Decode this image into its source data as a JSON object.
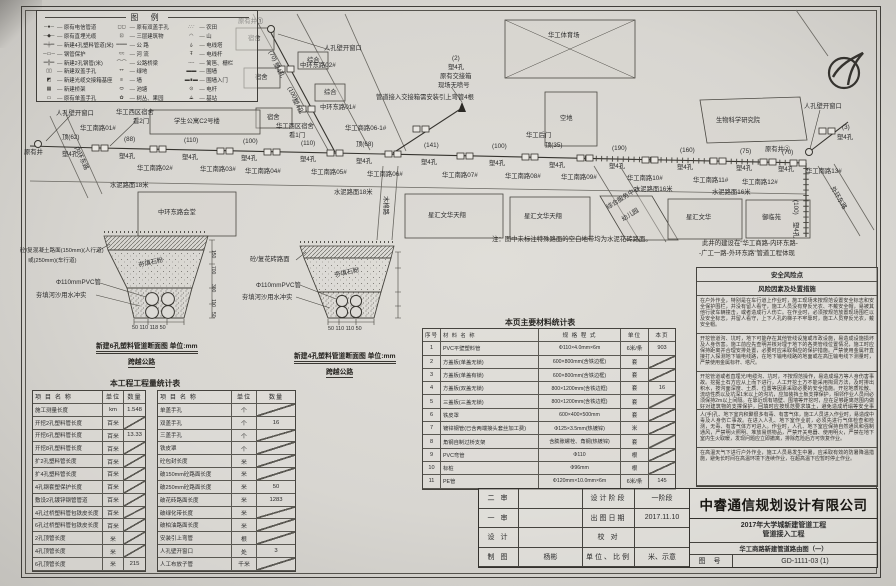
{
  "legend": {
    "title": "图 例",
    "col1": [
      {
        "sym": "─●─",
        "label": "原有电信管道"
      },
      {
        "sym": "─◆─",
        "label": "原有直埋光缆"
      },
      {
        "sym": "═╪═",
        "label": "新建4孔塑料管道(米)"
      },
      {
        "sym": "─▭─",
        "label": "钢管保护"
      },
      {
        "sym": "═╬═",
        "label": "新建2孔钢管(米)"
      },
      {
        "sym": "▯▯",
        "label": "新建双盖手孔"
      },
      {
        "sym": "◩",
        "label": "新建光缆交接箱基座"
      },
      {
        "sym": "▦",
        "label": "新建桥架"
      },
      {
        "sym": "▭",
        "label": "原有单盖手孔"
      }
    ],
    "col2": [
      {
        "sym": "◻◻",
        "label": "原有双盖手孔"
      },
      {
        "sym": "⊡",
        "label": "三层建筑物"
      },
      {
        "sym": "═══",
        "label": "公 路"
      },
      {
        "sym": "≈≈",
        "label": "河 流"
      },
      {
        "sym": "⌒⌒",
        "label": "公路桥梁"
      },
      {
        "sym": "艹",
        "label": "绿地"
      },
      {
        "sym": "≡",
        "label": "墙"
      },
      {
        "sym": "⬭",
        "label": "池塘"
      },
      {
        "sym": "✿",
        "label": "树丛、果园"
      }
    ],
    "col3": [
      {
        "sym": "∴∵",
        "label": "农田"
      },
      {
        "sym": "◠",
        "label": "山"
      },
      {
        "sym": "⍙",
        "label": "电线塔"
      },
      {
        "sym": "Ŧ",
        "label": "电线杆"
      },
      {
        "sym": "╌╌",
        "label": "篱笆、栅栏"
      },
      {
        "sym": "▬▬",
        "label": "围墙"
      },
      {
        "sym": "▬∎▬",
        "label": "围墙入门"
      },
      {
        "sym": "⊙",
        "label": "电杆"
      },
      {
        "sym": "⟁",
        "label": "基站"
      }
    ]
  },
  "plan": {
    "labels": [
      {
        "t": "原有井",
        "x": 24,
        "y": 150
      },
      {
        "t": "人孔壁开窗口",
        "x": 56,
        "y": 111
      },
      {
        "t": "华工西区宿舍",
        "x": 116,
        "y": 110
      },
      {
        "t": "看2门",
        "x": 133,
        "y": 119
      },
      {
        "t": "华工南路01#",
        "x": 80,
        "y": 126
      },
      {
        "t": "顶(62)",
        "x": 62,
        "y": 135
      },
      {
        "t": "塑4孔",
        "x": 62,
        "y": 152
      },
      {
        "t": "(88)",
        "x": 124,
        "y": 137
      },
      {
        "t": "塑4孔",
        "x": 119,
        "y": 154
      },
      {
        "t": "华工南路02#",
        "x": 137,
        "y": 166
      },
      {
        "t": "(110)",
        "x": 184,
        "y": 138
      },
      {
        "t": "塑4孔",
        "x": 182,
        "y": 155
      },
      {
        "t": "华工南路03#",
        "x": 200,
        "y": 167
      },
      {
        "t": "(100)",
        "x": 243,
        "y": 139
      },
      {
        "t": "塑4孔",
        "x": 241,
        "y": 156
      },
      {
        "t": "华工南路04#",
        "x": 245,
        "y": 169
      },
      {
        "t": "华工西区宿舍",
        "x": 276,
        "y": 124
      },
      {
        "t": "看1门",
        "x": 289,
        "y": 133
      },
      {
        "t": "(110)",
        "x": 301,
        "y": 141
      },
      {
        "t": "塑4孔",
        "x": 300,
        "y": 157
      },
      {
        "t": "华工南路05#",
        "x": 311,
        "y": 170
      },
      {
        "t": "顶(68)",
        "x": 356,
        "y": 142
      },
      {
        "t": "塑4孔",
        "x": 356,
        "y": 159
      },
      {
        "t": "华工南路06#",
        "x": 367,
        "y": 172
      },
      {
        "t": "华工商路06-1#",
        "x": 345,
        "y": 126
      },
      {
        "t": "(141)",
        "x": 424,
        "y": 143
      },
      {
        "t": "塑4孔",
        "x": 421,
        "y": 160
      },
      {
        "t": "华工南路07#",
        "x": 442,
        "y": 173
      },
      {
        "t": "(100)",
        "x": 492,
        "y": 144
      },
      {
        "t": "塑4孔",
        "x": 489,
        "y": 161
      },
      {
        "t": "华工南路08#",
        "x": 505,
        "y": 174
      },
      {
        "t": "华工后门",
        "x": 526,
        "y": 133
      },
      {
        "t": "顶(35)",
        "x": 545,
        "y": 143
      },
      {
        "t": "塑4孔",
        "x": 549,
        "y": 163
      },
      {
        "t": "华工南路09#",
        "x": 561,
        "y": 175
      },
      {
        "t": "(190)",
        "x": 612,
        "y": 146
      },
      {
        "t": "塑4孔",
        "x": 609,
        "y": 164
      },
      {
        "t": "华工南路10#",
        "x": 627,
        "y": 176
      },
      {
        "t": "(160)",
        "x": 680,
        "y": 148
      },
      {
        "t": "塑4孔",
        "x": 677,
        "y": 165
      },
      {
        "t": "华工南路11#",
        "x": 693,
        "y": 178
      },
      {
        "t": "(75)",
        "x": 740,
        "y": 149
      },
      {
        "t": "塑4孔",
        "x": 736,
        "y": 166
      },
      {
        "t": "华工南路12#",
        "x": 742,
        "y": 180
      },
      {
        "t": "(70)",
        "x": 782,
        "y": 150
      },
      {
        "t": "塑4孔",
        "x": 778,
        "y": 167
      },
      {
        "t": "华工南路13#",
        "x": 806,
        "y": 169
      },
      {
        "t": "原有井②",
        "x": 765,
        "y": 147
      },
      {
        "t": "(3)",
        "x": 842,
        "y": 125
      },
      {
        "t": "塑4孔",
        "x": 837,
        "y": 135
      },
      {
        "t": "人孔壁开窗口",
        "x": 804,
        "y": 104
      },
      {
        "t": "原有井①",
        "x": 238,
        "y": 19
      },
      {
        "t": "人孔壁开窗口",
        "x": 324,
        "y": 46
      },
      {
        "t": "(70)",
        "x": 272,
        "y": 50,
        "r": 62
      },
      {
        "t": "塑4孔",
        "x": 277,
        "y": 62,
        "r": 62
      },
      {
        "t": "中环东路02#",
        "x": 300,
        "y": 63
      },
      {
        "t": "(100)",
        "x": 291,
        "y": 86,
        "r": 62
      },
      {
        "t": "塑4孔",
        "x": 296,
        "y": 98,
        "r": 62
      },
      {
        "t": "中环东路01#",
        "x": 320,
        "y": 105
      },
      {
        "t": "宿舍",
        "x": 248,
        "y": 36
      },
      {
        "t": "宿舍",
        "x": 255,
        "y": 75
      },
      {
        "t": "宿舍",
        "x": 267,
        "y": 115
      },
      {
        "t": "综合",
        "x": 307,
        "y": 58
      },
      {
        "t": "综合",
        "x": 324,
        "y": 90
      },
      {
        "t": "学生公寓C2号楼",
        "x": 174,
        "y": 119
      },
      {
        "t": "(2)",
        "x": 452,
        "y": 56
      },
      {
        "t": "塑4孔",
        "x": 448,
        "y": 65
      },
      {
        "t": "原有交接箱",
        "x": 440,
        "y": 74
      },
      {
        "t": "现场无喷号",
        "x": 438,
        "y": 83
      },
      {
        "t": "管道接入交接箱需安装引上弯管4根",
        "x": 376,
        "y": 95
      },
      {
        "t": "华工体育场",
        "x": 548,
        "y": 33
      },
      {
        "t": "空地",
        "x": 560,
        "y": 116
      },
      {
        "t": "生物科学研究院",
        "x": 716,
        "y": 118
      },
      {
        "t": "水泥路面18米",
        "x": 110,
        "y": 183
      },
      {
        "t": "水泥路面18米",
        "x": 334,
        "y": 190
      },
      {
        "t": "水泥路面16米",
        "x": 634,
        "y": 187
      },
      {
        "t": "水泥路面16米",
        "x": 712,
        "y": 190
      },
      {
        "t": "中环东路会堂",
        "x": 158,
        "y": 210
      },
      {
        "t": "星汇文华天翔",
        "x": 428,
        "y": 213
      },
      {
        "t": "星汇文华天翔",
        "x": 524,
        "y": 214
      },
      {
        "t": "综合服务中心",
        "x": 606,
        "y": 206,
        "r": -32
      },
      {
        "t": "幼儿园",
        "x": 621,
        "y": 218,
        "r": -32
      },
      {
        "t": "星汇文华",
        "x": 686,
        "y": 215
      },
      {
        "t": "御临苑",
        "x": 762,
        "y": 215
      },
      {
        "t": "内环东路",
        "x": 78,
        "y": 146,
        "r": 65
      },
      {
        "t": "木棉路",
        "x": 388,
        "y": 196,
        "r": 90
      },
      {
        "t": "外环东路",
        "x": 834,
        "y": 186,
        "r": 59
      },
      {
        "t": "(100)",
        "x": 798,
        "y": 200,
        "r": 90
      },
      {
        "t": "塑4孔",
        "x": 798,
        "y": 222,
        "r": 90
      },
      {
        "t": "砼/复混凝土路面(150mm)(人行道)",
        "x": 20,
        "y": 249,
        "s": 5.6
      },
      {
        "t": "或(250mm)(车行道)",
        "x": 28,
        "y": 259,
        "s": 5.6
      },
      {
        "t": "Φ110mmPVC管",
        "x": 56,
        "y": 280
      },
      {
        "t": "夯填河沙用水冲实",
        "x": 36,
        "y": 293
      },
      {
        "t": "夯填石粉",
        "x": 138,
        "y": 263,
        "r": -12
      },
      {
        "t": "50 110 118 50",
        "x": 132,
        "y": 326,
        "s": 5.4
      },
      {
        "t": "150",
        "x": 215,
        "y": 250,
        "r": 90,
        "s": 5
      },
      {
        "t": "700",
        "x": 215,
        "y": 266,
        "r": 90,
        "s": 5
      },
      {
        "t": "300",
        "x": 215,
        "y": 284,
        "r": 90,
        "s": 5
      },
      {
        "t": "110",
        "x": 215,
        "y": 299,
        "r": 90,
        "s": 5
      },
      {
        "t": "50",
        "x": 215,
        "y": 312,
        "r": 90,
        "s": 5
      },
      {
        "t": "砼/复花砖路面",
        "x": 250,
        "y": 257
      },
      {
        "t": "Φ110mmPVC管",
        "x": 256,
        "y": 283
      },
      {
        "t": "夯填河沙用水冲实",
        "x": 242,
        "y": 295
      },
      {
        "t": "夯填石粉",
        "x": 334,
        "y": 273,
        "r": -12
      },
      {
        "t": "50 110 110 50",
        "x": 328,
        "y": 327,
        "s": 5.4
      }
    ]
  },
  "sections": {
    "a": {
      "caption": "新建6孔塑料管道断面图  单位:mm",
      "road": "跨越公路"
    },
    "b": {
      "caption": "新建4孔塑料管道断面图  单位:mm",
      "road": "跨越公路"
    }
  },
  "notes": {
    "pavement": "注：图中未标注特殊路面的空白地带均为水泥花砖路面。",
    "well1": "此井的建设在“华工商路-内环东路-",
    "well2": "-广工一路-外环东路”管道工程体现"
  },
  "project_table": {
    "title": "本工程工程量统计表",
    "h_name": "项 目 名 称",
    "h_unit": "单位",
    "h_qty": "数量",
    "left_rows": [
      [
        "施工测量长度",
        "km",
        "1.548"
      ],
      [
        "开挖2孔塑料管长度",
        "百米",
        ""
      ],
      [
        "开挖6孔塑料管长度",
        "百米",
        "13.33"
      ],
      [
        "开挖8孔塑料管长度",
        "百米",
        ""
      ],
      [
        "扩2孔塑料管长度",
        "百米",
        ""
      ],
      [
        "扩4孔塑料管长度",
        "百米",
        ""
      ],
      [
        "4孔钢套塑保护长度",
        "百米",
        ""
      ],
      [
        "敷设2孔镀锌钢管管道",
        "百米",
        ""
      ],
      [
        "4孔过桥塑料管包铁皮长度",
        "百米",
        ""
      ],
      [
        "6孔过桥塑料管包铁皮长度",
        "百米",
        ""
      ],
      [
        "2孔顶管长度",
        "米",
        ""
      ],
      [
        "4孔顶管长度",
        "米",
        ""
      ],
      [
        "6孔顶管长度",
        "米",
        "215"
      ]
    ],
    "right_rows": [
      [
        "单盖手孔",
        "个",
        ""
      ],
      [
        "双盖手孔",
        "个",
        "16"
      ],
      [
        "三盖手孔",
        "个",
        ""
      ],
      [
        "铁皮罩",
        "个",
        ""
      ],
      [
        "砼包封长度",
        "米",
        ""
      ],
      [
        "破150mm砼路面长度",
        "米",
        ""
      ],
      [
        "破250mm砼路面长度",
        "米",
        "50"
      ],
      [
        "破花砖路面长度",
        "米",
        "1283"
      ],
      [
        "破绿化带长度",
        "米",
        ""
      ],
      [
        "破柏油路面长度",
        "米",
        ""
      ],
      [
        "安装引上弯管",
        "根",
        ""
      ],
      [
        "人孔壁开窗口",
        "处",
        "3"
      ],
      [
        "人工布放子管",
        "千米",
        ""
      ]
    ]
  },
  "materials_table": {
    "title": "本页主要材料统计表",
    "headers": [
      "序号",
      "材 料 名 称",
      "规 格 程 式",
      "单位",
      "本页"
    ],
    "rows": [
      [
        "1",
        "PVC平壁塑料管",
        "Φ110×4.0mm×6m",
        "6米/条",
        "903"
      ],
      [
        "2",
        "方盖板(单盖无锁)",
        "600×800mm(含铁边框)",
        "套",
        ""
      ],
      [
        "3",
        "方盖板(单盖有锁)",
        "600×800mm(含铁边框)",
        "套",
        ""
      ],
      [
        "4",
        "方盖板(双盖无锁)",
        "800×1200mm(含铁边框)",
        "套",
        "16"
      ],
      [
        "5",
        "三盖板(三盖无锁)",
        "800×1200mm(含铁边框)",
        "套",
        ""
      ],
      [
        "6",
        "铁皮罩",
        "600×400×500mm",
        "套",
        ""
      ],
      [
        "7",
        "镀锌钢管(已含两端接头套丝加工费)",
        "Φ125×3.5mm(热镀锌)",
        "米",
        ""
      ],
      [
        "8",
        "角钢自制过桥支架",
        "含膨胀螺栓、角钢(热镀锌)",
        "套",
        ""
      ],
      [
        "9",
        "PVC弯管",
        "Φ110",
        "根",
        ""
      ],
      [
        "10",
        "标桩",
        "Φ96mm",
        "根",
        ""
      ],
      [
        "11",
        "PE管",
        "Φ120mm×10.0mm×6m",
        "6米/条",
        "145"
      ]
    ]
  },
  "safety": {
    "title": "安全风险点",
    "subtitle": "风险因素及处置措施",
    "paragraphs": [
      "在户外作业，特别是在车行道上作业时，施工现场未按规范设置安全标志和安全保护围栏，并没有留人看守，施工人员没有穿反光衣、不戴安全帽，易被其他行驶车辆撞击，或者造成行人伤亡。在作业时，必须按规范放置现场围栏以及安全标志，并留人看守，上下人孔的梯子不牢靠时，施工人员穿反光衣，戴安全帽。",
      "开挖管道沟、坑时，地下可能存在其他管线设施或市政设施，易造成设施损坏及人身伤害。施工前应先查明并核对埋于地下的各类管线位置情况，施工时应保持距离并合理安排处置，必要时应采取相应的保护措施。严禁使用金属杆直接打入探测地下输电线路，在地下输电线路的地面或在高压输电线下测量时，严禁使用金属标杆、塔尺。",
      "开挖管道或者直埋光/电缆沟、坑时，不按规范操作，易造成塌方等人身伤害事故。挖掘土石方应从上而下进行，人工开挖土方不能采用掏洞方法，及时排出积水，按沟面深度、土质、位置等因素采取必要的安全措施。开挖地质松散、流动性质以及坑深1米以上的沟坑，应加装挡土板支撑保护，相邻作业人员间必须保持2m以上间隔。在靠近现有墙壁、围墙等开挖时，应在足够距离范围内做好对建筑物的支撑保护，回填时应按规范要求填土，避免造成坍塌等安全事故。",
      "人(手)孔、地下室内积聚很多有毒、有害气体，施工人员进入作业时，易造成中毒及人身伤亡事故。在进入人孔、地下室作业前，必须先进行气体检查和检测，无毒、有害气体方可进入。作业时，人孔、地下室应保持自然通风和强制通风，严禁明火照明、堆放易燃物品，严禁开关电器、使用明火，严禁在地下室内生火取暖，发现问题应立即撤离，排除危险后方可恢复作业。",
      "在高温天气下进行户外作业，施工人员易发生中暑，应采取有效的防暑降温措施，避免长时间在高温环境下连续作业，在超高温下应暂时停止作业。"
    ]
  },
  "titleblock": {
    "company": "中睿通信规划设计有限公司",
    "project_line1": "2017年大学城新建管道工程",
    "project_line2": "管道接入工程",
    "sheet_title": "华工商路新建管道路由图（一）",
    "drawing_no_label": "图 号",
    "drawing_no": "GD-1111-03 (1)",
    "rows": [
      {
        "l1": "二 审",
        "v1": "",
        "l2": "设计阶段",
        "v2": "一阶段"
      },
      {
        "l1": "一 审",
        "v1": "",
        "l2": "出图日期",
        "v2": "2017.11.10"
      },
      {
        "l1": "设 计",
        "v1": "",
        "l2": "校 对",
        "v2": ""
      },
      {
        "l1": "制 图",
        "v1": "杨彬",
        "l2": "单位、比例",
        "v2": "米、示意"
      }
    ]
  }
}
